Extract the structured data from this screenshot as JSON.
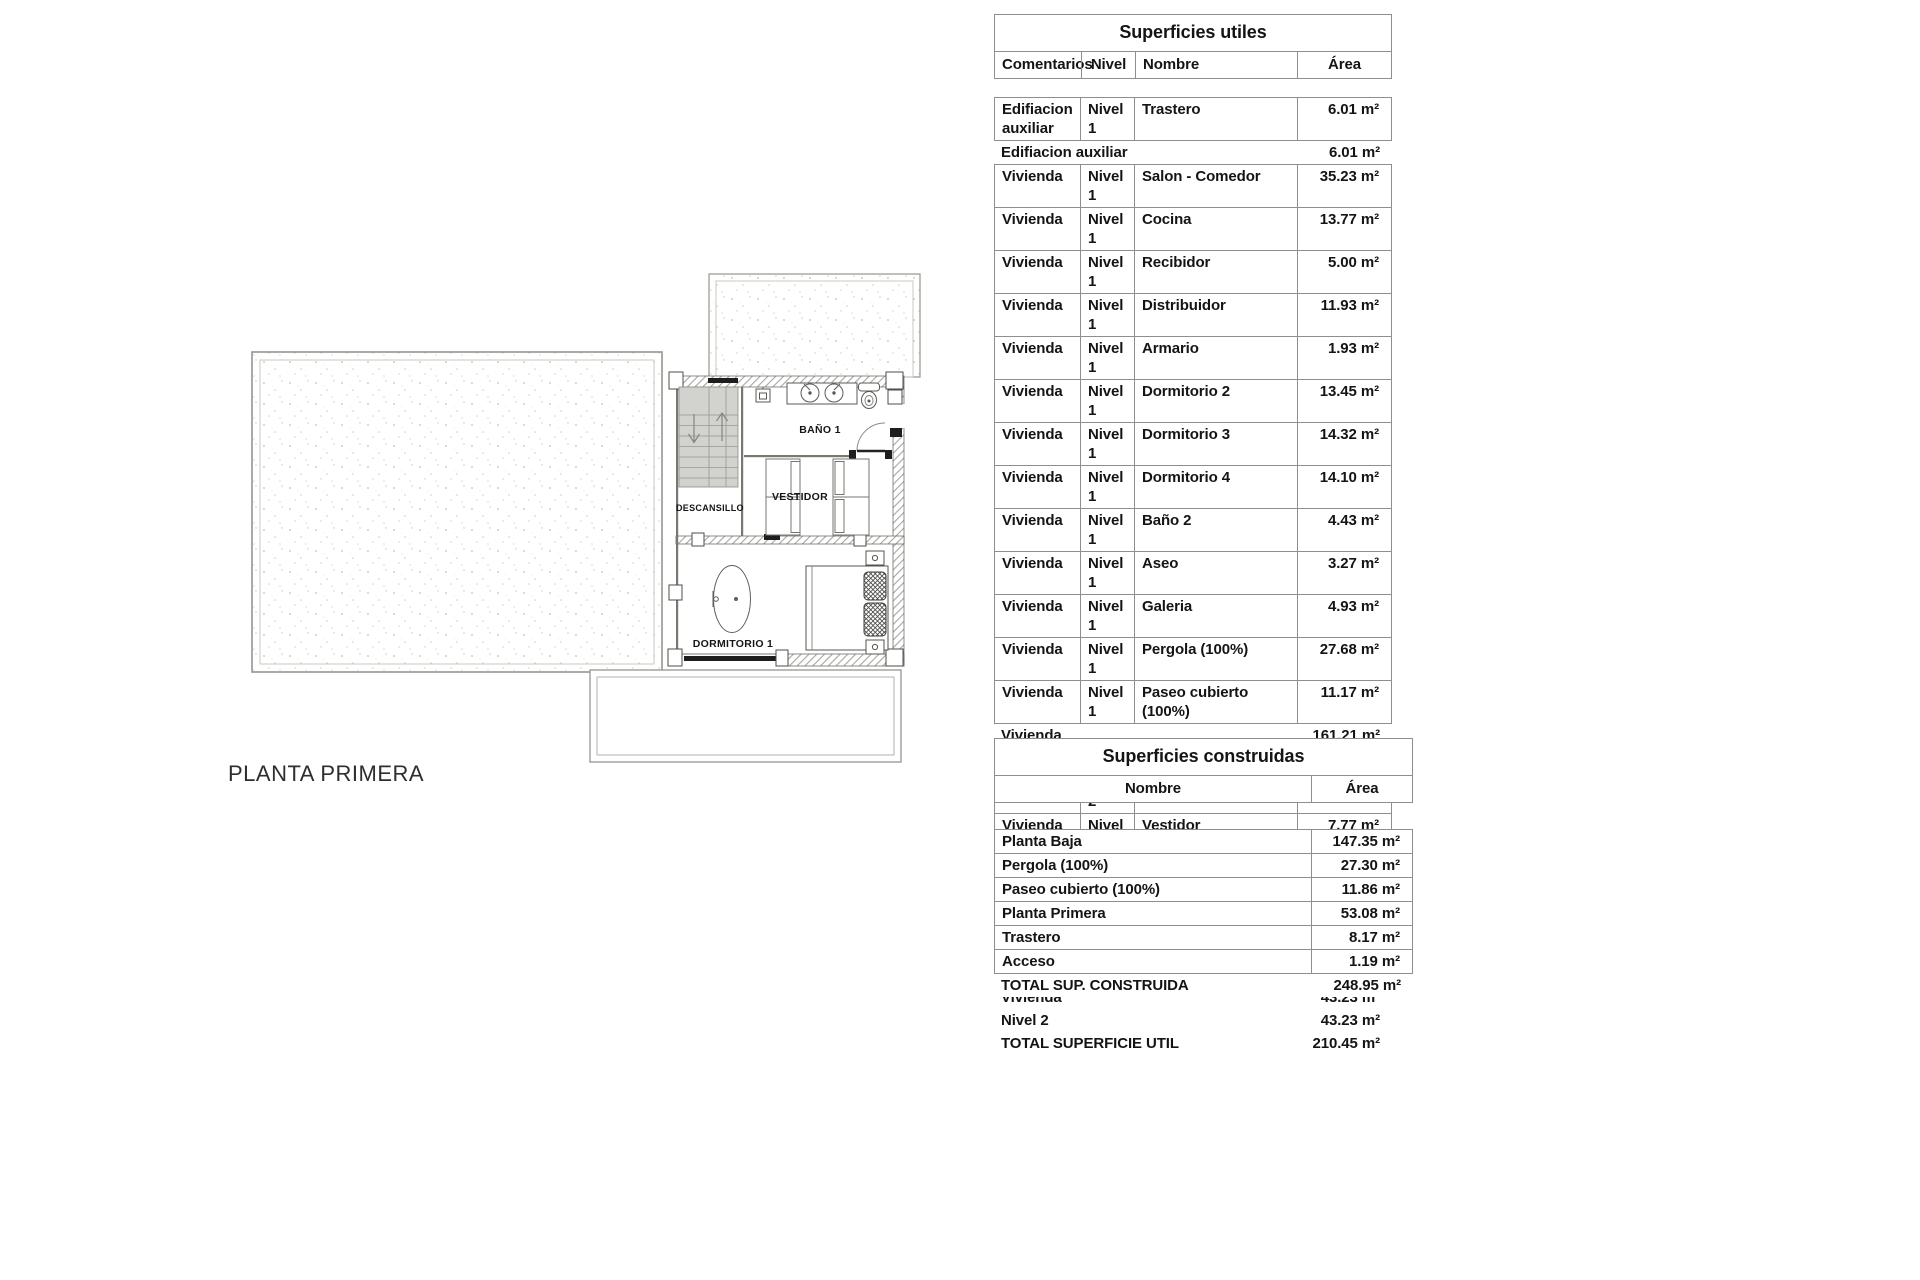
{
  "floor_plan": {
    "caption": "PLANTA PRIMERA",
    "rooms": {
      "descansillo": "DESCANSILLO",
      "bano1": "BAÑO 1",
      "vestidor": "VESTIDOR",
      "dormitorio1": "DORMITORIO 1"
    }
  },
  "superficies_utiles": {
    "title": "Superficies utiles",
    "headers": {
      "comentarios": "Comentarios",
      "nivel": "Nivel",
      "nombre": "Nombre",
      "area": "Área"
    },
    "rows": [
      {
        "cls": "detail",
        "comentarios": "Edifiacion auxiliar",
        "nivel": "Nivel 1",
        "nombre": "Trastero",
        "area": "6.01 m²"
      },
      {
        "cls": "summary",
        "label": "Edifiacion auxiliar",
        "area": "6.01 m²"
      },
      {
        "cls": "detail",
        "comentarios": "Vivienda",
        "nivel": "Nivel 1",
        "nombre": "Salon - Comedor",
        "area": "35.23 m²"
      },
      {
        "cls": "detail",
        "comentarios": "Vivienda",
        "nivel": "Nivel 1",
        "nombre": "Cocina",
        "area": "13.77 m²"
      },
      {
        "cls": "detail",
        "comentarios": "Vivienda",
        "nivel": "Nivel 1",
        "nombre": "Recibidor",
        "area": "5.00 m²"
      },
      {
        "cls": "detail",
        "comentarios": "Vivienda",
        "nivel": "Nivel 1",
        "nombre": "Distribuidor",
        "area": "11.93 m²"
      },
      {
        "cls": "detail",
        "comentarios": "Vivienda",
        "nivel": "Nivel 1",
        "nombre": "Armario",
        "area": "1.93 m²"
      },
      {
        "cls": "detail",
        "comentarios": "Vivienda",
        "nivel": "Nivel 1",
        "nombre": "Dormitorio 2",
        "area": "13.45 m²"
      },
      {
        "cls": "detail",
        "comentarios": "Vivienda",
        "nivel": "Nivel 1",
        "nombre": "Dormitorio 3",
        "area": "14.32 m²"
      },
      {
        "cls": "detail",
        "comentarios": "Vivienda",
        "nivel": "Nivel 1",
        "nombre": "Dormitorio 4",
        "area": "14.10 m²"
      },
      {
        "cls": "detail",
        "comentarios": "Vivienda",
        "nivel": "Nivel 1",
        "nombre": "Baño 2",
        "area": "4.43 m²"
      },
      {
        "cls": "detail",
        "comentarios": "Vivienda",
        "nivel": "Nivel 1",
        "nombre": "Aseo",
        "area": "3.27 m²"
      },
      {
        "cls": "detail",
        "comentarios": "Vivienda",
        "nivel": "Nivel 1",
        "nombre": "Galeria",
        "area": "4.93 m²"
      },
      {
        "cls": "detail",
        "comentarios": "Vivienda",
        "nivel": "Nivel 1",
        "nombre": "Pergola (100%)",
        "area": "27.68 m²"
      },
      {
        "cls": "detail",
        "comentarios": "Vivienda",
        "nivel": "Nivel 1",
        "nombre": "Paseo cubierto (100%)",
        "area": "11.17 m²"
      },
      {
        "cls": "summary",
        "label": "Vivienda",
        "area": "161.21 m²"
      },
      {
        "cls": "summary",
        "label": "Nivel 1",
        "area": "167.22 m²"
      },
      {
        "cls": "detail",
        "comentarios": "Vivienda",
        "nivel": "Nivel 2",
        "nombre": "Descansillo",
        "area": "2.17 m²"
      },
      {
        "cls": "detail",
        "comentarios": "Vivienda",
        "nivel": "Nivel 2",
        "nombre": "Vestidor",
        "area": "7.77 m²"
      },
      {
        "cls": "detail",
        "comentarios": "Vivienda",
        "nivel": "Nivel 2",
        "nombre": "Baño 1",
        "area": "7.93 m²"
      },
      {
        "cls": "detail",
        "comentarios": "Vivienda",
        "nivel": "Nivel 2",
        "nombre": "Dormitorio 1",
        "area": "20.21 m²"
      },
      {
        "cls": "detail",
        "comentarios": "Vivienda",
        "nivel": "Nivel 2",
        "nombre": "Escalera",
        "area": "5.15 m²"
      },
      {
        "cls": "summary",
        "label": "Vivienda",
        "area": "43.23 m²"
      },
      {
        "cls": "summary",
        "label": "Nivel 2",
        "area": "43.23 m²"
      },
      {
        "cls": "summary total",
        "label": "TOTAL SUPERFICIE UTIL",
        "area": "210.45 m²"
      }
    ]
  },
  "superficies_construidas": {
    "title": "Superficies construidas",
    "headers": {
      "nombre": "Nombre",
      "area": "Área"
    },
    "rows": [
      {
        "cls": "detail",
        "nombre": "Planta Baja",
        "area": "147.35 m²"
      },
      {
        "cls": "detail",
        "nombre": "Pergola (100%)",
        "area": "27.30 m²"
      },
      {
        "cls": "detail",
        "nombre": "Paseo cubierto (100%)",
        "area": "11.86 m²"
      },
      {
        "cls": "detail",
        "nombre": "Planta Primera",
        "area": "53.08 m²"
      },
      {
        "cls": "detail",
        "nombre": "Trastero",
        "area": "8.17 m²"
      },
      {
        "cls": "detail",
        "nombre": "Acceso",
        "area": "1.19 m²"
      },
      {
        "cls": "summary total",
        "label": "TOTAL SUP. CONSTRUIDA",
        "area": "248.95 m²"
      }
    ]
  },
  "colors": {
    "line": "#8e8e8e",
    "wall_hatch": "#a6a6a0",
    "stair_fill": "#d2d2ce",
    "text": "#141414"
  }
}
